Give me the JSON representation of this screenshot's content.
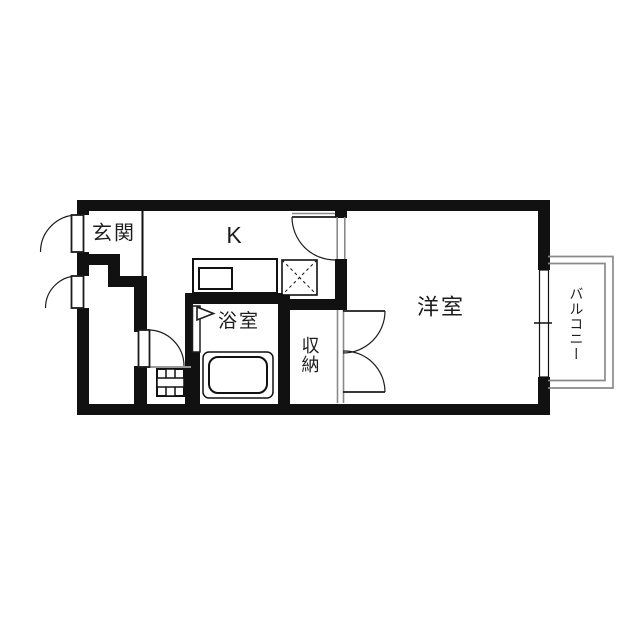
{
  "title": "1K apartment floor plan",
  "colors": {
    "wall": "#111111",
    "line": "#1c1c1c",
    "door_frame": "#8a8a8a",
    "background": "#ffffff",
    "text": "#1d1d1d"
  },
  "rooms": {
    "genkan": {
      "label": "玄関"
    },
    "kitchen": {
      "label": "K"
    },
    "bathroom": {
      "label": "浴室"
    },
    "closet": {
      "label": "収納"
    },
    "western": {
      "label": "洋室"
    },
    "balcony": {
      "label": "バルコニー"
    }
  },
  "fixtures": [
    "entry-door",
    "service-door",
    "utility-room-door",
    "kitchen-door",
    "closet-double-door",
    "bathroom-folding-door",
    "kitchen-counter",
    "kitchen-sink",
    "refrigerator-space",
    "washing-machine-pan",
    "bathtub",
    "sliding-window",
    "balcony-railing"
  ]
}
